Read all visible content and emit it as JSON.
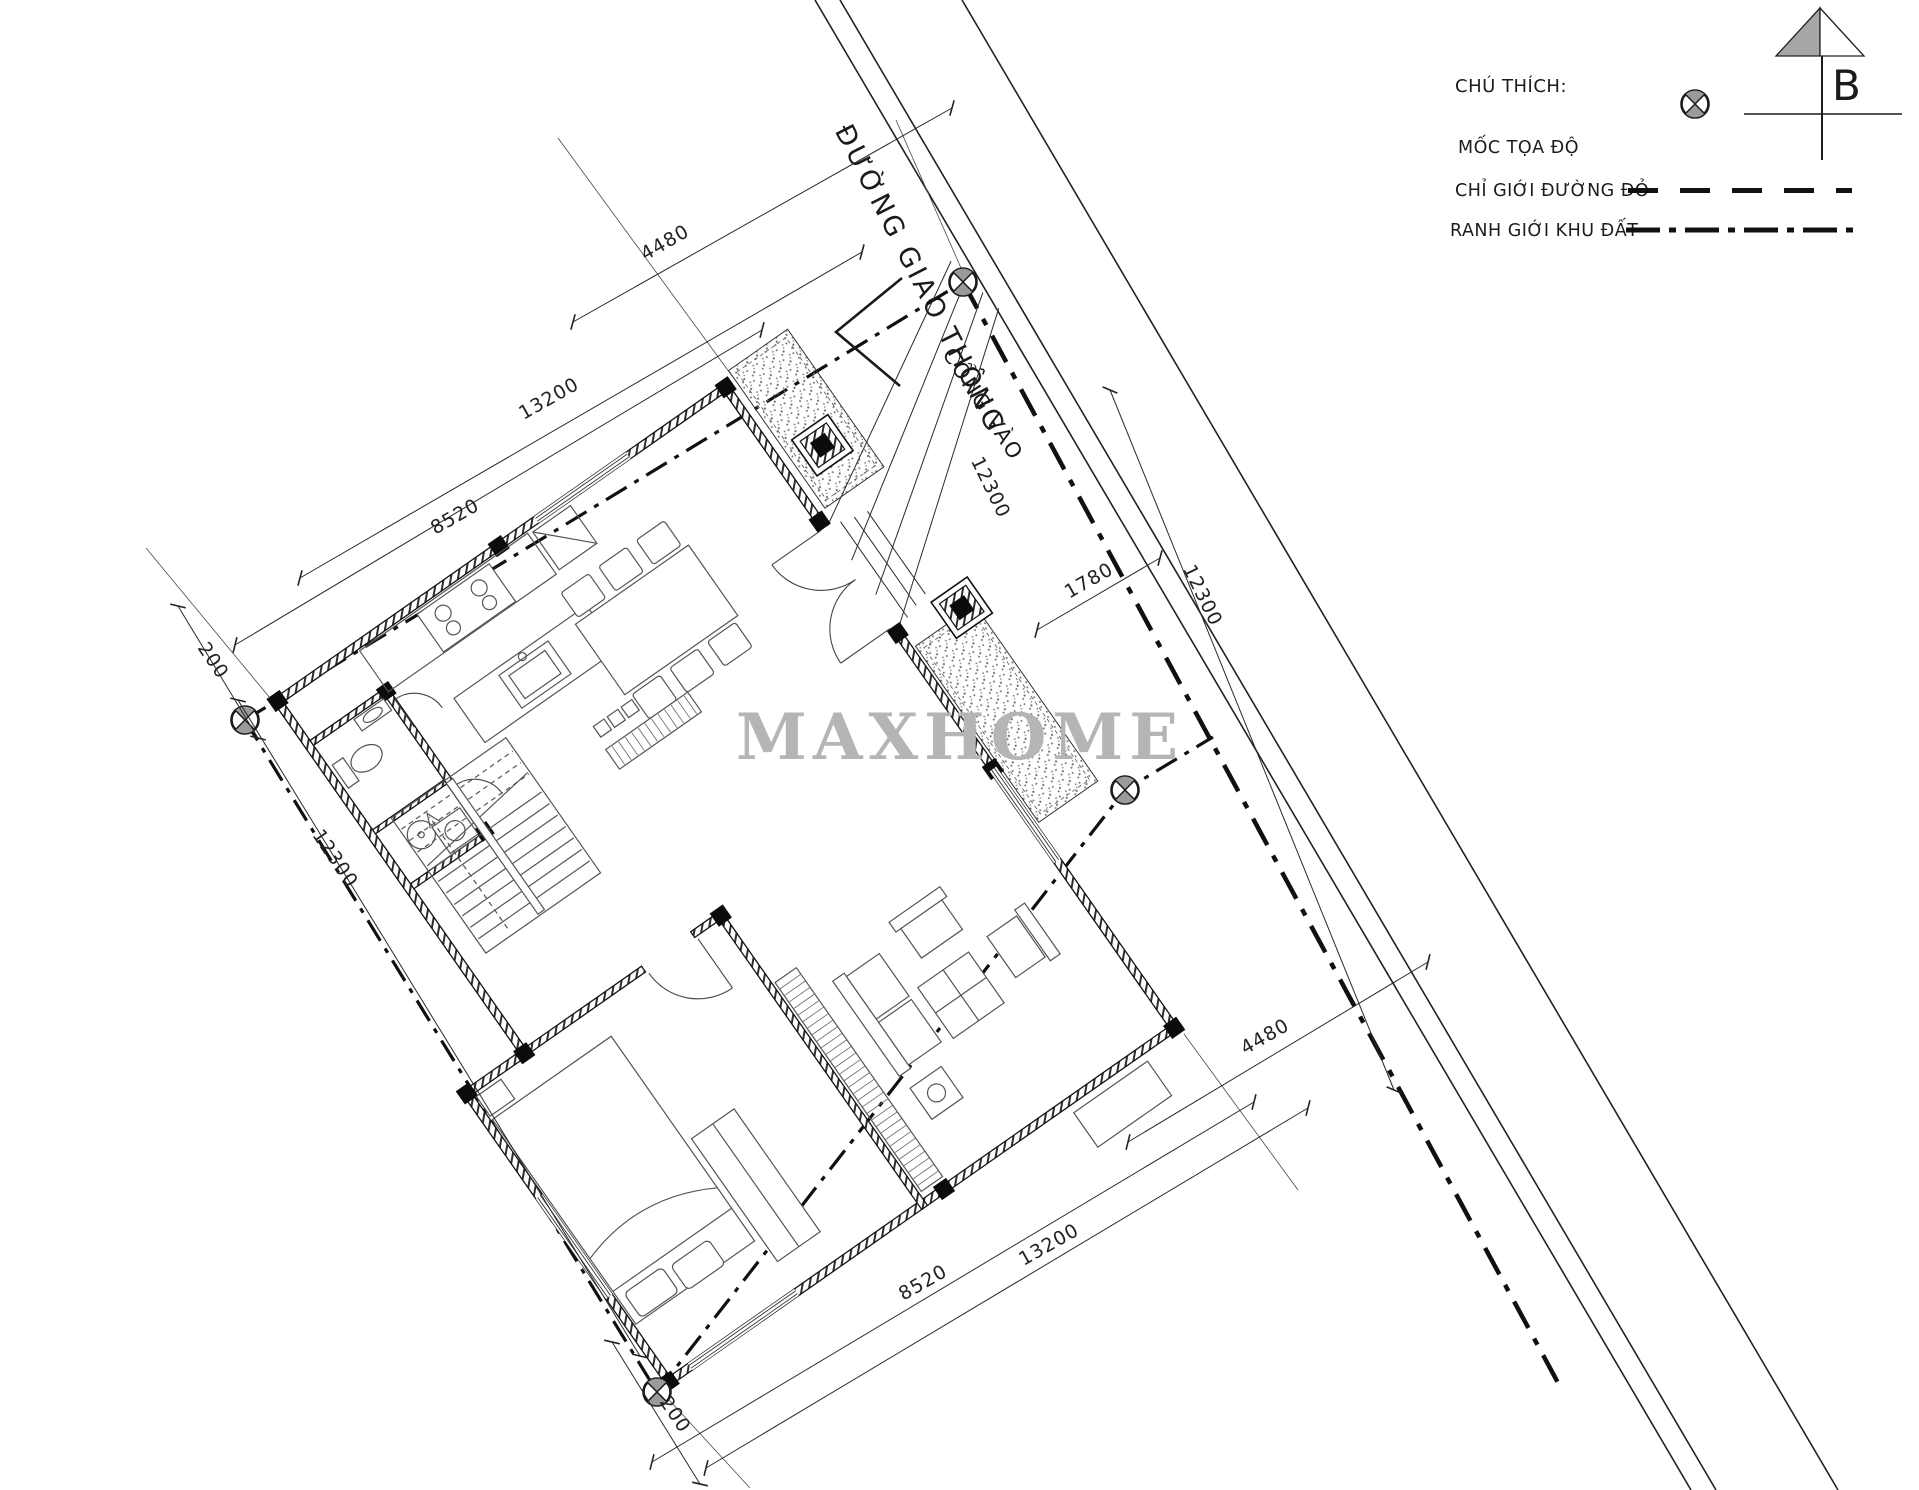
{
  "legend": {
    "title": "CHÚ THÍCH:",
    "items": [
      {
        "label": "MỐC TỌA ĐỘ",
        "symbol": "survey-marker-icon"
      },
      {
        "label": "CHỈ GIỚI ĐƯỜNG ĐỎ",
        "symbol": "dashed-line-icon"
      },
      {
        "label": "RANH GIỚI KHU ĐẤT",
        "symbol": "dash-dot-line-icon"
      }
    ]
  },
  "north_arrow": {
    "label": "B"
  },
  "road": {
    "name": "ĐƯỜNG GIAO THÔNG"
  },
  "gate": {
    "label": "CỔNG VÀO"
  },
  "watermark": {
    "text": "MAXHOME"
  },
  "dimension_labels": [
    {
      "id": "top-4480",
      "value": "4480"
    },
    {
      "id": "topleft-13200",
      "value": "13200"
    },
    {
      "id": "topleft-8520",
      "value": "8520"
    },
    {
      "id": "left-200",
      "value": "200"
    },
    {
      "id": "left-12300",
      "value": "12300"
    },
    {
      "id": "bottom-200",
      "value": "200"
    },
    {
      "id": "bottom-13200",
      "value": "13200"
    },
    {
      "id": "bottom-8520",
      "value": "8520"
    },
    {
      "id": "bottomright-4480",
      "value": "4480"
    },
    {
      "id": "road-12300",
      "value": "12300"
    },
    {
      "id": "boundary-12300",
      "value": "12300"
    },
    {
      "id": "walkway-1780",
      "value": "1780"
    }
  ],
  "colors": {
    "line": "#1a1a1a",
    "watermark": "#b5b5b5",
    "marker_fill": "#9a9a9a"
  }
}
